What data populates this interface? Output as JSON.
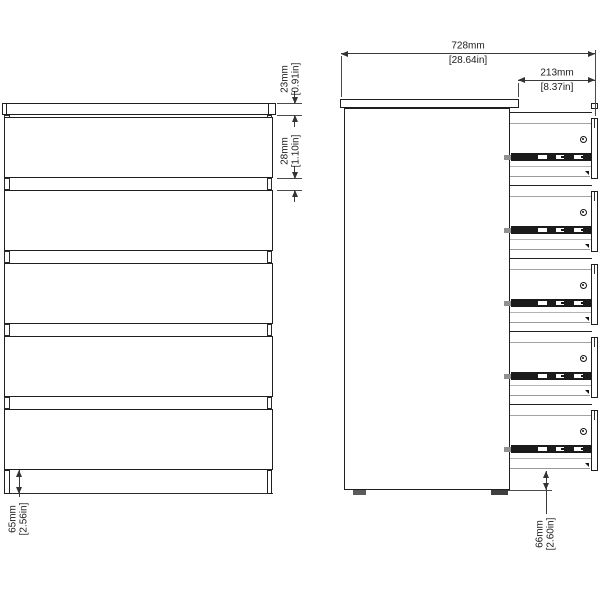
{
  "drawing": {
    "front_view": {
      "drawer_count": 5,
      "dim_top": {
        "mm": "23mm",
        "in": "[0.91in]"
      },
      "dim_gap": {
        "mm": "28mm",
        "in": "[1.10in]"
      },
      "dim_base": {
        "mm": "65mm",
        "in": "[2.56in]"
      }
    },
    "side_view": {
      "drawer_count": 5,
      "dim_depth": {
        "mm": "728mm",
        "in": "[28.64in]"
      },
      "dim_extension": {
        "mm": "213mm",
        "in": "[8.37in]"
      },
      "dim_floor": {
        "mm": "66mm",
        "in": "[2.60in]"
      }
    },
    "colors": {
      "outline": "#1f1f1f",
      "light_line": "#a3a3a3",
      "dimension": "#333333",
      "background": "#ffffff"
    }
  }
}
